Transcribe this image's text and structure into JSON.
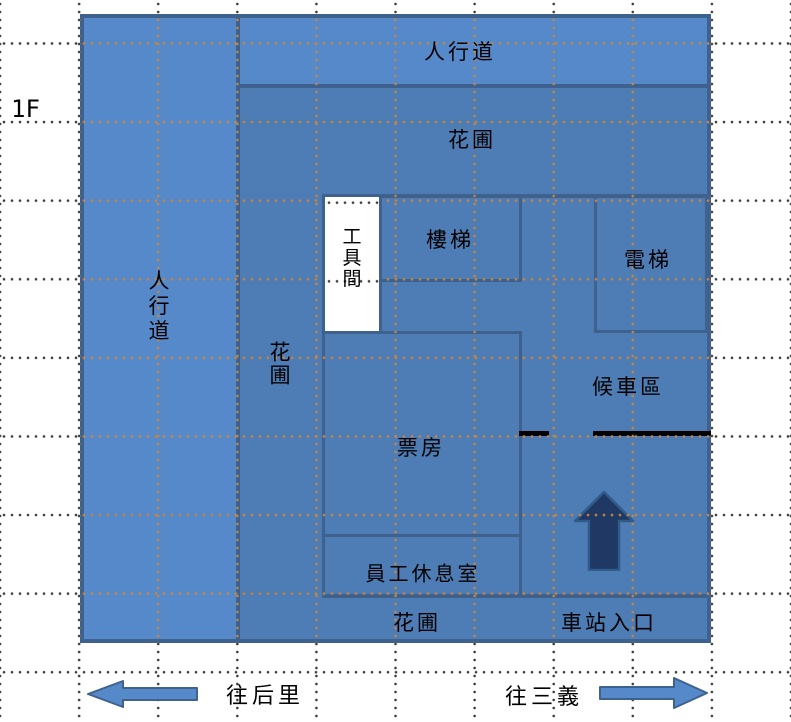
{
  "floor_label": "1F",
  "labels": {
    "sidewalk_left": "人行道",
    "sidewalk_top": "人行道",
    "garden_top": "花圃",
    "garden_left": "花圃",
    "garden_bottom": "花圃",
    "tool_room": "工具間",
    "stairs": "樓梯",
    "elevator": "電梯",
    "waiting_area": "候車區",
    "ticket_office": "票房",
    "staff_lounge": "員工休息室",
    "station_entrance": "車站入口",
    "direction_left": "往后里",
    "direction_right": "往三義"
  },
  "icons": {
    "entrance_up_arrow": "up-arrow-icon",
    "to_houli_arrow": "left-arrow-icon",
    "to_sanyi_arrow": "right-arrow-icon"
  },
  "colors": {
    "sidewalk_fill": "#5689CA",
    "plan_fill": "#4E7CB4",
    "wall_border": "#3E618E",
    "tool_room_fill": "#FFFFFF",
    "entrance_arrow_fill": "#1F3864",
    "entrance_arrow_stroke": "#2F5B88",
    "gate_line": "#000000",
    "grid_dots_on_plan": "#C8853F",
    "grid_dots_on_page": "#3C3C3C"
  }
}
